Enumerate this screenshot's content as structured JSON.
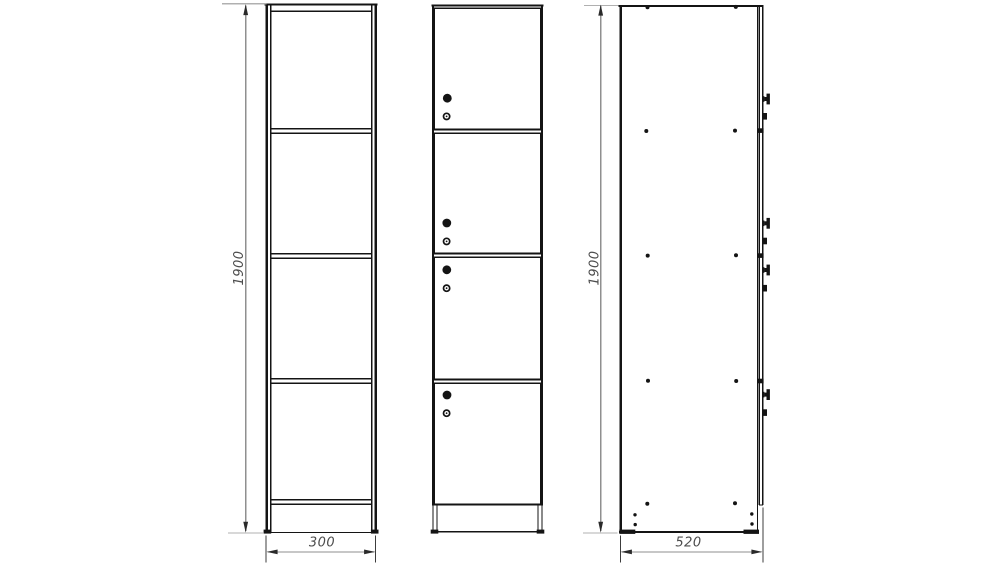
{
  "drawing": {
    "type": "furniture-technical-drawing",
    "colors": {
      "background": "#ffffff",
      "object_line": "#141414",
      "dimension_line": "#8f8f8f",
      "extension_line": "#b0b0b0",
      "label_text": "#4d4d4d"
    },
    "views": [
      {
        "id": "front-carcass",
        "compartments": 4,
        "shelf_lines": 3
      },
      {
        "id": "front-doors",
        "doors": 4,
        "knobs": 4,
        "locks": 4
      },
      {
        "id": "side",
        "screw_rows": 5,
        "knob_profiles": 4,
        "lock_profiles": 4
      }
    ],
    "dimensions": {
      "front_height": "1900",
      "front_width": "300",
      "side_height": "1900",
      "side_depth": "520"
    }
  }
}
